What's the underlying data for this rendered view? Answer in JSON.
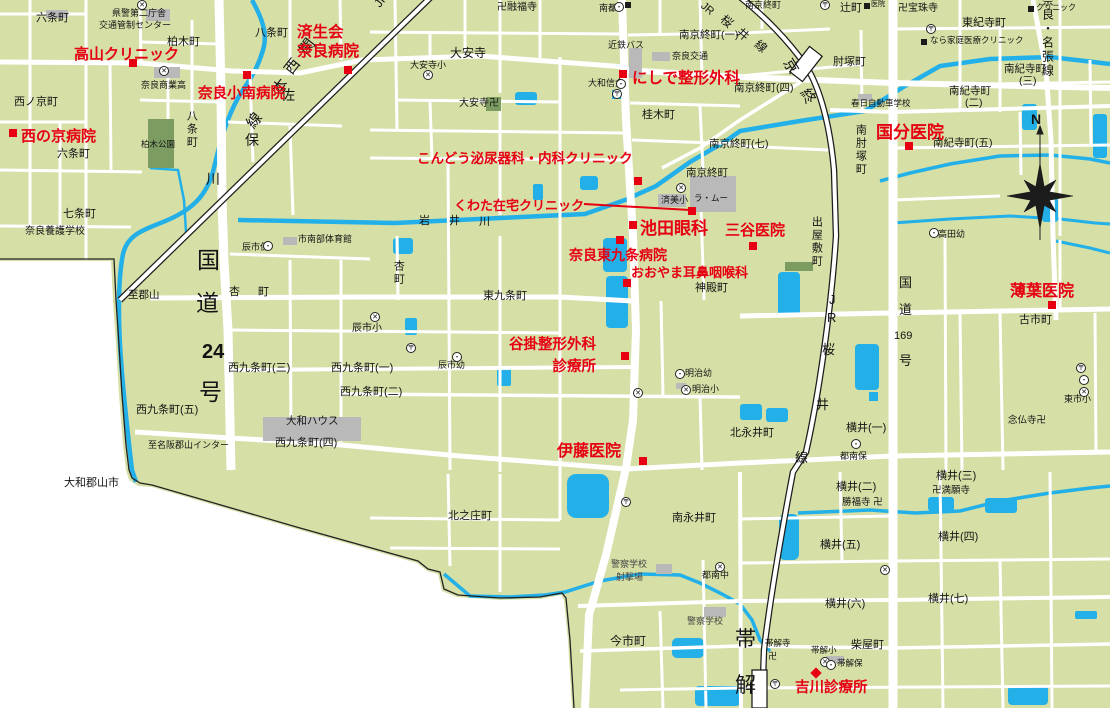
{
  "map": {
    "colors": {
      "land": "#d5dfa6",
      "water": "#23b0e8",
      "road": "#ffffff",
      "park": "#7d9c62",
      "building": "#b9b9b9",
      "red": "#e60012",
      "rail": "#1c1c1c",
      "text": "#141414",
      "boundary": "#222222"
    },
    "compass": {
      "label": "N"
    },
    "connector": {
      "x1": 584,
      "y1": 204,
      "x2": 690,
      "y2": 210
    },
    "hospitals": [
      {
        "id": "takayama-clinic",
        "lines": [
          "高山クリニック"
        ],
        "x": 74,
        "y": 44,
        "s": 15,
        "marker": {
          "x": 129,
          "y": 59,
          "shape": "square"
        }
      },
      {
        "id": "saiseikai-nara-hospital",
        "lines": [
          "済生会",
          "奈良病院"
        ],
        "x": 297,
        "y": 24,
        "s": 15.5,
        "lh": 1.2,
        "marker": {
          "x": 344,
          "y": 66,
          "shape": "square"
        }
      },
      {
        "id": "nara-konan-hospital",
        "lines": [
          "奈良小南病院"
        ],
        "x": 198,
        "y": 84,
        "s": 14.5,
        "marker": {
          "x": 243,
          "y": 71,
          "shape": "square"
        }
      },
      {
        "id": "nishinokyo-hospital",
        "lines": [
          "西の京病院"
        ],
        "x": 21,
        "y": 126,
        "s": 15,
        "marker": {
          "x": 9,
          "y": 129,
          "shape": "square"
        }
      },
      {
        "id": "nishide-seikeigeka",
        "lines": [
          "にしで整形外科"
        ],
        "x": 632,
        "y": 67,
        "s": 15.5,
        "marker": {
          "x": 619,
          "y": 70,
          "shape": "square"
        }
      },
      {
        "id": "kokubu-iin",
        "lines": [
          "国分医院"
        ],
        "x": 876,
        "y": 120,
        "s": 17,
        "marker": {
          "x": 905,
          "y": 142,
          "shape": "square"
        }
      },
      {
        "id": "kondo-hinyokika-naika-clinic",
        "lines": [
          "こんどう泌尿器科・内科クリニック"
        ],
        "x": 417,
        "y": 149,
        "s": 13.5,
        "marker": {
          "x": 634,
          "y": 177,
          "shape": "square"
        }
      },
      {
        "id": "kuwata-zaitaku-clinic",
        "lines": [
          "くわた在宅クリニック"
        ],
        "x": 454,
        "y": 196,
        "s": 13,
        "marker": {
          "x": 688,
          "y": 207,
          "shape": "square"
        }
      },
      {
        "id": "ikeda-ganka",
        "lines": [
          "池田眼科"
        ],
        "x": 640,
        "y": 216,
        "s": 17,
        "marker": {
          "x": 629,
          "y": 221,
          "shape": "square"
        }
      },
      {
        "id": "mitani-iin",
        "lines": [
          "三谷医院"
        ],
        "x": 725,
        "y": 220,
        "s": 15,
        "marker": {
          "x": 749,
          "y": 242,
          "shape": "square"
        }
      },
      {
        "id": "nara-higashikujo-hospital",
        "lines": [
          "奈良東九条病院"
        ],
        "x": 569,
        "y": 245,
        "s": 14,
        "marker": {
          "x": 616,
          "y": 236,
          "shape": "square"
        }
      },
      {
        "id": "oyama-jibiinkoka",
        "lines": [
          "おおやま耳鼻咽喉科"
        ],
        "x": 631,
        "y": 263,
        "s": 13,
        "marker": {
          "x": 623,
          "y": 279,
          "shape": "square"
        }
      },
      {
        "id": "tanigake-seikeigeka-shinryojo",
        "lines": [
          "谷掛整形外科",
          "　　　診療所"
        ],
        "x": 509,
        "y": 334,
        "s": 14.5,
        "lh": 1.55,
        "marker": {
          "x": 621,
          "y": 352,
          "shape": "square"
        }
      },
      {
        "id": "ito-iin",
        "lines": [
          "伊藤医院"
        ],
        "x": 557,
        "y": 440,
        "s": 16,
        "marker": {
          "x": 639,
          "y": 457,
          "shape": "square"
        }
      },
      {
        "id": "usuha-iin",
        "lines": [
          "薄葉医院"
        ],
        "x": 1010,
        "y": 280,
        "s": 16,
        "marker": {
          "x": 1048,
          "y": 301,
          "shape": "square"
        }
      },
      {
        "id": "yoshikawa-shinryojo",
        "lines": [
          "吉川診療所"
        ],
        "x": 795,
        "y": 678,
        "s": 14.5,
        "marker": {
          "x": 812,
          "y": 669,
          "shape": "diamond"
        }
      }
    ],
    "places": [
      {
        "t": "六条町",
        "x": 36,
        "y": 12
      },
      {
        "t": "県警第二庁舎",
        "x": 112,
        "y": 8,
        "s": 9
      },
      {
        "t": "交通管制センター",
        "x": 99,
        "y": 20,
        "s": 9
      },
      {
        "t": "柏木町",
        "x": 167,
        "y": 36
      },
      {
        "t": "八条町",
        "x": 255,
        "y": 27
      },
      {
        "t": "西ノ京町",
        "x": 14,
        "y": 96
      },
      {
        "t": "六条町",
        "x": 57,
        "y": 148
      },
      {
        "t": "七条町",
        "x": 63,
        "y": 208
      },
      {
        "t": "奈良養護学校",
        "x": 25,
        "y": 226,
        "s": 10
      },
      {
        "t": "奈良商業高",
        "x": 141,
        "y": 80,
        "s": 9
      },
      {
        "t": "柏木公園",
        "x": 141,
        "y": 140,
        "s": 8.5
      },
      {
        "t": "八条町",
        "x": 185,
        "y": 110,
        "v": true
      },
      {
        "t": "佐",
        "x": 281,
        "y": 88,
        "s": 14
      },
      {
        "t": "保",
        "x": 245,
        "y": 133,
        "s": 14
      },
      {
        "t": "川",
        "x": 206,
        "y": 172,
        "s": 14
      },
      {
        "t": "大安寺",
        "x": 450,
        "y": 47,
        "s": 12
      },
      {
        "t": "大安寺小",
        "x": 410,
        "y": 60,
        "s": 9
      },
      {
        "t": "大安寺卍",
        "x": 459,
        "y": 98,
        "s": 10
      },
      {
        "t": "卍融福寺",
        "x": 497,
        "y": 2,
        "s": 10
      },
      {
        "t": "南都",
        "x": 599,
        "y": 3,
        "s": 9
      },
      {
        "t": "近鉄バス",
        "x": 608,
        "y": 40,
        "s": 9
      },
      {
        "t": "南京終町(一)",
        "x": 679,
        "y": 30,
        "s": 10.5
      },
      {
        "t": "奈良交通",
        "x": 672,
        "y": 51,
        "s": 9
      },
      {
        "t": "大和信金",
        "x": 588,
        "y": 78,
        "s": 9
      },
      {
        "t": "桂木町",
        "x": 642,
        "y": 109
      },
      {
        "t": "南京終町",
        "x": 745,
        "y": 0,
        "s": 9
      },
      {
        "t": "南京終町(四)",
        "x": 734,
        "y": 83,
        "s": 10.5
      },
      {
        "t": "肘塚町",
        "x": 833,
        "y": 56
      },
      {
        "t": "辻町",
        "x": 840,
        "y": 2
      },
      {
        "t": "卍宝珠寺",
        "x": 898,
        "y": 3,
        "s": 10
      },
      {
        "t": "東紀寺町",
        "x": 962,
        "y": 17
      },
      {
        "t": "なら家庭医療クリニック",
        "x": 930,
        "y": 36,
        "s": 8.5
      },
      {
        "t": "クリニック",
        "x": 1036,
        "y": 4,
        "s": 8
      },
      {
        "t": "医院",
        "x": 871,
        "y": 1,
        "s": 7
      },
      {
        "t": "南紀寺町",
        "x": 1004,
        "y": 64,
        "s": 10.5
      },
      {
        "t": "(三)",
        "x": 1019,
        "y": 76,
        "s": 10.5
      },
      {
        "t": "南紀寺町",
        "x": 949,
        "y": 86,
        "s": 10.5
      },
      {
        "t": "(二)",
        "x": 965,
        "y": 98,
        "s": 10.5
      },
      {
        "t": "南紀寺町(五)",
        "x": 933,
        "y": 138,
        "s": 10.5
      },
      {
        "t": "春日自動車学校",
        "x": 851,
        "y": 99,
        "s": 8.5
      },
      {
        "t": "南京終町(七)",
        "x": 709,
        "y": 139,
        "s": 10.5
      },
      {
        "t": "南京終町",
        "x": 686,
        "y": 168,
        "s": 10.5
      },
      {
        "t": "出屋敷町",
        "x": 810,
        "y": 216,
        "v": true
      },
      {
        "t": "南肘塚町",
        "x": 854,
        "y": 124,
        "v": true
      },
      {
        "t": "古市町",
        "x": 1019,
        "y": 314
      },
      {
        "t": "東市小",
        "x": 1064,
        "y": 394,
        "s": 9
      },
      {
        "t": "念仏寺卍",
        "x": 1008,
        "y": 416,
        "s": 9.5
      },
      {
        "t": "横井(一)",
        "x": 846,
        "y": 422
      },
      {
        "t": "都南保",
        "x": 840,
        "y": 451,
        "s": 9
      },
      {
        "t": "高田幼",
        "x": 938,
        "y": 229,
        "s": 9
      },
      {
        "t": "神殿町",
        "x": 695,
        "y": 282
      },
      {
        "t": "東九条町",
        "x": 483,
        "y": 290
      },
      {
        "t": "杏",
        "x": 229,
        "y": 286
      },
      {
        "t": "町",
        "x": 258,
        "y": 286
      },
      {
        "t": "杏町",
        "x": 392,
        "y": 260,
        "v": true
      },
      {
        "t": "辰市小",
        "x": 352,
        "y": 323,
        "s": 10
      },
      {
        "t": "辰市幼",
        "x": 438,
        "y": 360,
        "s": 9
      },
      {
        "t": "辰市保",
        "x": 242,
        "y": 242,
        "s": 9
      },
      {
        "t": "市南部体育館",
        "x": 298,
        "y": 234,
        "s": 9
      },
      {
        "t": "至郡山",
        "x": 128,
        "y": 290,
        "s": 10.5
      },
      {
        "t": "西九条町(三)",
        "x": 228,
        "y": 362
      },
      {
        "t": "西九条町(一)",
        "x": 331,
        "y": 362
      },
      {
        "t": "西九条町(二)",
        "x": 340,
        "y": 386
      },
      {
        "t": "西九条町(五)",
        "x": 136,
        "y": 404
      },
      {
        "t": "大和ハウス",
        "x": 286,
        "y": 416,
        "s": 10.5
      },
      {
        "t": "西九条町(四)",
        "x": 275,
        "y": 437
      },
      {
        "t": "至名阪郡山インター",
        "x": 148,
        "y": 440,
        "s": 9
      },
      {
        "t": "大和郡山市",
        "x": 64,
        "y": 477
      },
      {
        "t": "北之庄町",
        "x": 448,
        "y": 510
      },
      {
        "t": "南永井町",
        "x": 672,
        "y": 512
      },
      {
        "t": "北永井町",
        "x": 730,
        "y": 427
      },
      {
        "t": "今市町",
        "x": 610,
        "y": 635,
        "s": 12
      },
      {
        "t": "警察学校",
        "x": 611,
        "y": 559,
        "s": 9,
        "c": "#444444"
      },
      {
        "t": "射撃場",
        "x": 616,
        "y": 572,
        "s": 9,
        "c": "#444444"
      },
      {
        "t": "警察学校",
        "x": 687,
        "y": 616,
        "s": 9,
        "c": "#444444"
      },
      {
        "t": "都南中",
        "x": 702,
        "y": 570,
        "s": 9
      },
      {
        "t": "明治幼",
        "x": 685,
        "y": 368,
        "s": 9
      },
      {
        "t": "明治小",
        "x": 692,
        "y": 384,
        "s": 9
      },
      {
        "t": "横井(二)",
        "x": 836,
        "y": 481
      },
      {
        "t": "横井(三)",
        "x": 936,
        "y": 470
      },
      {
        "t": "勝福寺 卍",
        "x": 842,
        "y": 498,
        "s": 9.5
      },
      {
        "t": "卍満願寺",
        "x": 932,
        "y": 486,
        "s": 9.5
      },
      {
        "t": "横井(五)",
        "x": 820,
        "y": 539
      },
      {
        "t": "横井(四)",
        "x": 938,
        "y": 531
      },
      {
        "t": "横井(六)",
        "x": 825,
        "y": 598
      },
      {
        "t": "横井(七)",
        "x": 928,
        "y": 593
      },
      {
        "t": "柴屋町",
        "x": 851,
        "y": 639
      },
      {
        "t": "帯解寺",
        "x": 765,
        "y": 639,
        "s": 8.5
      },
      {
        "t": "卍",
        "x": 768,
        "y": 651,
        "s": 9
      },
      {
        "t": "帯解小",
        "x": 811,
        "y": 646,
        "s": 8.5
      },
      {
        "t": "帯解保",
        "x": 837,
        "y": 659,
        "s": 8.5
      },
      {
        "t": "済美小",
        "x": 661,
        "y": 195,
        "s": 9
      },
      {
        "t": "ラ・ムー",
        "x": 694,
        "y": 194,
        "s": 8.5
      },
      {
        "t": "岩",
        "x": 419,
        "y": 215
      },
      {
        "t": "井",
        "x": 449,
        "y": 215
      },
      {
        "t": "川",
        "x": 479,
        "y": 216
      },
      {
        "t": "国",
        "x": 197,
        "y": 248,
        "s": 23
      },
      {
        "t": "道",
        "x": 196,
        "y": 291,
        "s": 23
      },
      {
        "t": "24",
        "x": 202,
        "y": 341,
        "s": 20,
        "b": true
      },
      {
        "t": "号",
        "x": 199,
        "y": 380,
        "s": 23
      },
      {
        "t": "国",
        "x": 899,
        "y": 276,
        "s": 13
      },
      {
        "t": "道",
        "x": 899,
        "y": 303,
        "s": 13
      },
      {
        "t": "169",
        "x": 894,
        "y": 330,
        "s": 11
      },
      {
        "t": "号",
        "x": 899,
        "y": 354,
        "s": 13
      },
      {
        "t": "JR",
        "x": 372,
        "y": 2,
        "s": 12,
        "r": -52
      },
      {
        "t": "関",
        "x": 297,
        "y": 48,
        "s": 15,
        "r": -52
      },
      {
        "t": "西",
        "x": 282,
        "y": 68,
        "s": 15,
        "r": -52
      },
      {
        "t": "本",
        "x": 270,
        "y": 88,
        "s": 15,
        "r": -52
      },
      {
        "t": "線",
        "x": 244,
        "y": 122,
        "s": 15,
        "r": -52
      },
      {
        "t": "JR",
        "x": 706,
        "y": 0,
        "s": 11,
        "r": 40
      },
      {
        "t": "桜",
        "x": 726,
        "y": 13,
        "s": 12,
        "r": 40
      },
      {
        "t": "井",
        "x": 742,
        "y": 26,
        "s": 12,
        "r": 40
      },
      {
        "t": "線",
        "x": 760,
        "y": 38,
        "s": 12,
        "r": 40
      },
      {
        "t": "京",
        "x": 793,
        "y": 56,
        "s": 15,
        "r": 58
      },
      {
        "t": "終",
        "x": 810,
        "y": 86,
        "s": 15,
        "r": 58
      },
      {
        "t": "J",
        "x": 829,
        "y": 293,
        "s": 13
      },
      {
        "t": "R",
        "x": 827,
        "y": 311,
        "s": 13
      },
      {
        "t": "桜",
        "x": 822,
        "y": 343,
        "s": 13
      },
      {
        "t": "井",
        "x": 816,
        "y": 398,
        "s": 13
      },
      {
        "t": "線",
        "x": 795,
        "y": 451,
        "s": 13
      },
      {
        "t": "帯",
        "x": 735,
        "y": 628,
        "s": 21
      },
      {
        "t": "解",
        "x": 735,
        "y": 674,
        "s": 21
      },
      {
        "t": "奈良・名張線",
        "x": 1040,
        "y": -6,
        "s": 12,
        "v": true
      }
    ],
    "icons": [
      {
        "g": "school",
        "x": 137,
        "y": 0
      },
      {
        "g": "school",
        "x": 423,
        "y": 70
      },
      {
        "g": "school",
        "x": 159,
        "y": 66
      },
      {
        "g": "school",
        "x": 370,
        "y": 312
      },
      {
        "g": "school",
        "x": 676,
        "y": 183
      },
      {
        "g": "school",
        "x": 715,
        "y": 562
      },
      {
        "g": "school",
        "x": 820,
        "y": 657
      },
      {
        "g": "school",
        "x": 681,
        "y": 385
      },
      {
        "g": "school",
        "x": 633,
        "y": 388
      },
      {
        "g": "school",
        "x": 880,
        "y": 565
      },
      {
        "g": "school",
        "x": 1079,
        "y": 387
      },
      {
        "g": "post",
        "x": 820,
        "y": 0
      },
      {
        "g": "post",
        "x": 926,
        "y": 24
      },
      {
        "g": "post",
        "x": 612,
        "y": 89
      },
      {
        "g": "post",
        "x": 406,
        "y": 343
      },
      {
        "g": "post",
        "x": 621,
        "y": 497
      },
      {
        "g": "post",
        "x": 770,
        "y": 679
      },
      {
        "g": "post",
        "x": 1076,
        "y": 363
      },
      {
        "g": "dot",
        "x": 614,
        "y": 2
      },
      {
        "g": "dot",
        "x": 616,
        "y": 79
      },
      {
        "g": "dot",
        "x": 263,
        "y": 241
      },
      {
        "g": "dot",
        "x": 452,
        "y": 352
      },
      {
        "g": "dot",
        "x": 675,
        "y": 369
      },
      {
        "g": "dot",
        "x": 929,
        "y": 228
      },
      {
        "g": "dot",
        "x": 851,
        "y": 439
      },
      {
        "g": "dot",
        "x": 826,
        "y": 660
      },
      {
        "g": "dot",
        "x": 1079,
        "y": 375
      },
      {
        "g": "sq",
        "x": 625,
        "y": 2
      },
      {
        "g": "sq",
        "x": 864,
        "y": 3
      },
      {
        "g": "sq",
        "x": 921,
        "y": 39
      },
      {
        "g": "sq",
        "x": 1028,
        "y": 6
      }
    ]
  }
}
